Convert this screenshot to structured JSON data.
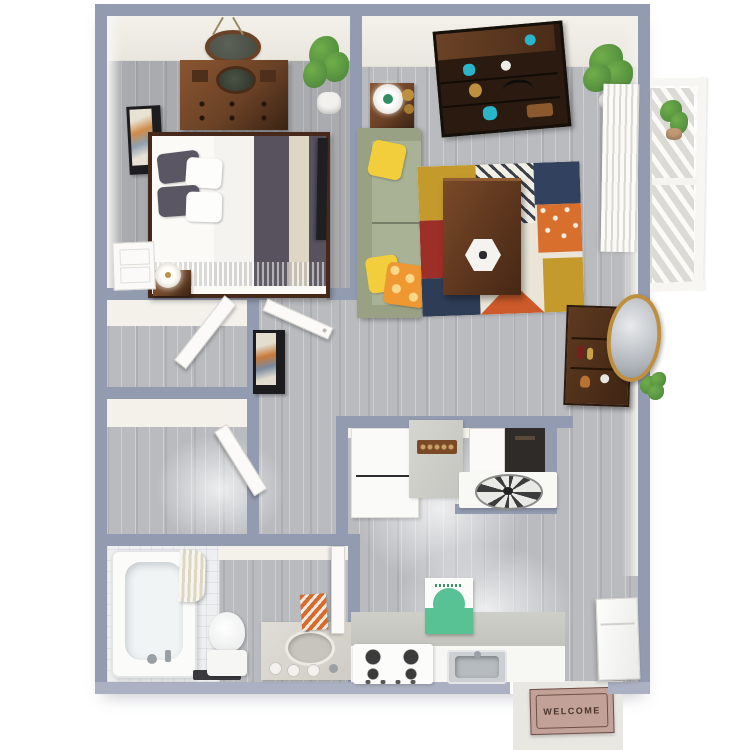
{
  "meta": {
    "image_type": "3d-floorplan-render",
    "description": "Top-down 3D rendering of a one-bedroom, one-bathroom apartment floor plan with balcony and entry welcome mat"
  },
  "entry": {
    "mat_text": "WELCOME"
  },
  "palette": {
    "wall": "#939bb0",
    "wallBottom": "#abb0c2",
    "cream": "#f3f1ea",
    "white": "#f7f6f3",
    "floor": "#b9bbbf",
    "tile": "#edeff1",
    "woodDark": "#3a2314",
    "wood": "#6b4226",
    "woodMid": "#8a5530",
    "sofa": "#a9b295",
    "sofaDark": "#98a184",
    "yellow": "#f2ce3d",
    "orange": "#ef9731",
    "teal": "#2ab5c9",
    "plant": "#6fae4a",
    "plantDark": "#49813a",
    "rugCream": "#eae5d8",
    "rugMustard": "#c49a2c",
    "rugRed": "#9c2f27",
    "rugNavy": "#31415e",
    "rugOrange": "#d86f2d",
    "matBg": "#c2a198",
    "matLine": "#6d5048",
    "matText": "#4a352c",
    "walkway": "#e9e7e1",
    "concrete": "#dcdad4",
    "counter": "#c9c9c4",
    "marble": "#d6d4cd",
    "greenArt": "#58c295",
    "dark": "#26262a",
    "chrome": "#9aa0a6",
    "gold": "#bd8f3e"
  },
  "rooms": [
    {
      "id": "bedroom",
      "objects": [
        "round-mirror",
        "dresser",
        "potted-plant",
        "wall-art",
        "bed",
        "pillows",
        "nightstand",
        "lamp",
        "tv",
        "door-panel"
      ]
    },
    {
      "id": "living-room",
      "objects": [
        "bookshelf",
        "corner-plant",
        "vertical-blinds",
        "side-table",
        "table-lamp",
        "gold-vases",
        "sofa",
        "yellow-pillows",
        "orange-pillow",
        "area-rug",
        "coffee-table",
        "hex-tray"
      ]
    },
    {
      "id": "hallway",
      "objects": [
        "framed-picture",
        "bar-cabinet",
        "round-wall-mirror"
      ]
    },
    {
      "id": "closet-1",
      "objects": [
        "closet-door"
      ]
    },
    {
      "id": "closet-2",
      "objects": [
        "closet-door"
      ]
    },
    {
      "id": "bathroom",
      "objects": [
        "bathtub",
        "shower-curtain",
        "toilet",
        "bath-mat",
        "vanity",
        "sink",
        "towel",
        "door"
      ]
    },
    {
      "id": "kitchen",
      "objects": [
        "tall-cabinet",
        "counter",
        "utensil-rack",
        "pantry",
        "pantry-door",
        "ceiling-fan",
        "stove",
        "green-artwork",
        "kitchen-sink",
        "backsplash"
      ]
    },
    {
      "id": "entry",
      "objects": [
        "refrigerator",
        "welcome-mat",
        "walkway"
      ]
    },
    {
      "id": "balcony",
      "objects": [
        "railing",
        "balcony-plant",
        "concrete-floor",
        "outside-shrub"
      ]
    }
  ]
}
